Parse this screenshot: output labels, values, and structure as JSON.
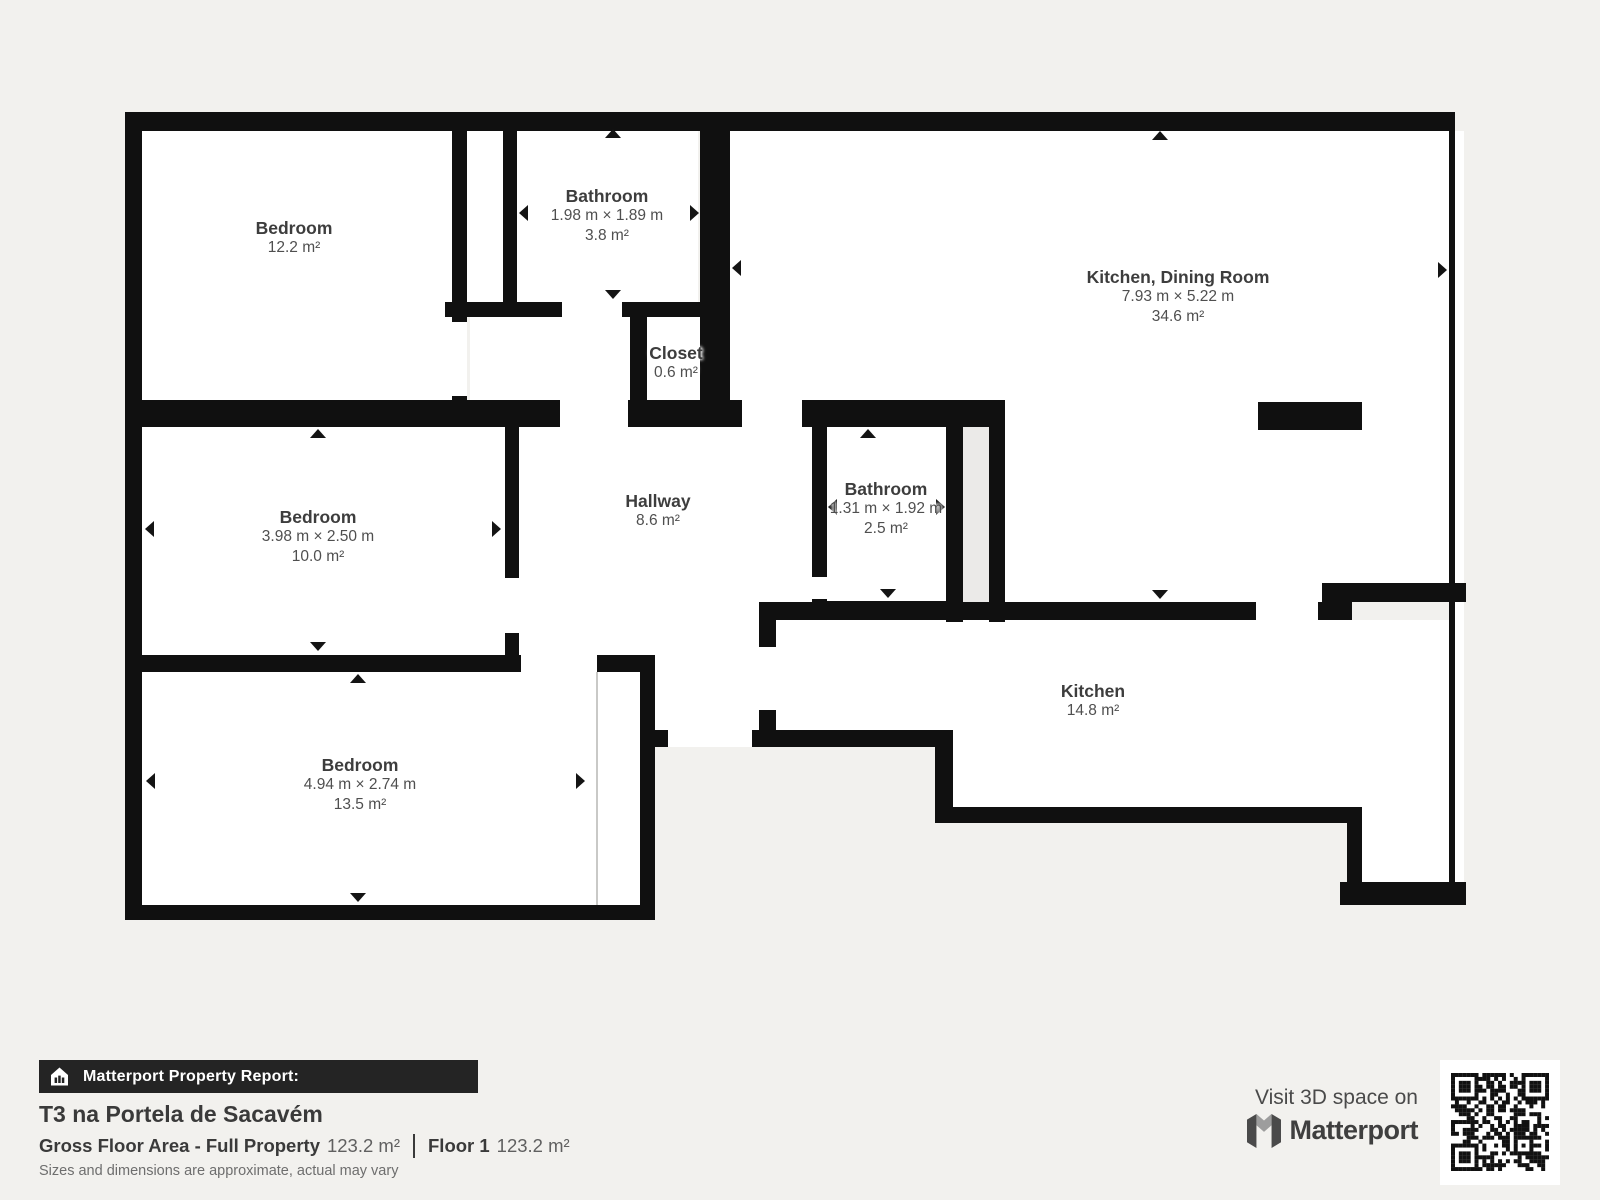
{
  "rooms": [
    {
      "id": "bedroom-1",
      "name": "Bedroom",
      "dims": "",
      "area": "12.2 m²"
    },
    {
      "id": "bathroom-1",
      "name": "Bathroom",
      "dims": "1.98 m × 1.89 m",
      "area": "3.8 m²"
    },
    {
      "id": "closet",
      "name": "Closet",
      "dims": "",
      "area": "0.6 m²"
    },
    {
      "id": "kitchen-dining",
      "name": "Kitchen, Dining Room",
      "dims": "7.93 m × 5.22 m",
      "area": "34.6 m²"
    },
    {
      "id": "bedroom-2",
      "name": "Bedroom",
      "dims": "3.98 m × 2.50 m",
      "area": "10.0 m²"
    },
    {
      "id": "hallway",
      "name": "Hallway",
      "dims": "",
      "area": "8.6 m²"
    },
    {
      "id": "bathroom-2",
      "name": "Bathroom",
      "dims": "1.31 m × 1.92 m",
      "area": "2.5 m²"
    },
    {
      "id": "kitchen",
      "name": "Kitchen",
      "dims": "",
      "area": "14.8 m²"
    },
    {
      "id": "bedroom-3",
      "name": "Bedroom",
      "dims": "4.94 m × 2.74 m",
      "area": "13.5 m²"
    }
  ],
  "footer": {
    "report_label": "Matterport Property Report:",
    "property_title": "T3 na Portela de Sacavém",
    "gfa_label": "Gross Floor Area - Full Property",
    "gfa_value": "123.2 m²",
    "floor_label": "Floor 1",
    "floor_value": "123.2 m²",
    "disclaimer": "Sizes and dimensions are approximate, actual may vary",
    "visit_text": "Visit 3D space on",
    "brand": "Matterport"
  },
  "colors": {
    "wall": "#101010",
    "background": "#f2f1ee",
    "room": "#ffffff",
    "shaft": "#ebeae8",
    "label": "#3d3d3d"
  }
}
